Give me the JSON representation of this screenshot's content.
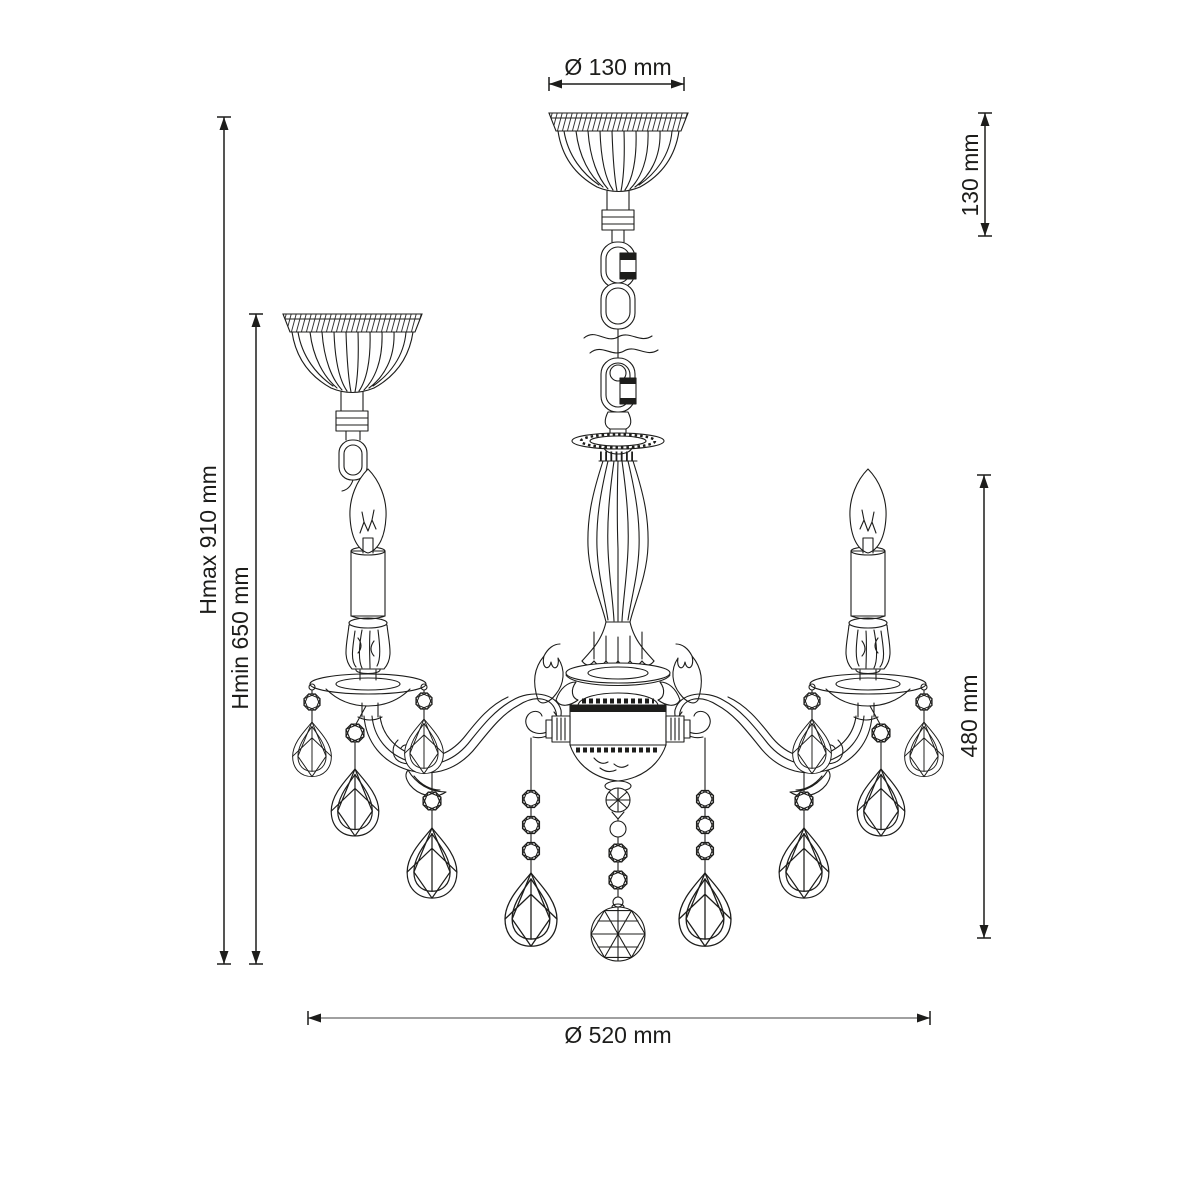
{
  "drawing": {
    "subject": "chandelier-technical-line-drawing",
    "background_color": "#ffffff",
    "line_color": "#1d1d1b",
    "dimension_line_color": "#1d1d1b",
    "bottom_dimension_line_color": "#808080"
  },
  "dimensions": {
    "canopy_diameter": "Ø 130 mm",
    "canopy_height": "130 mm",
    "max_height": "Hmax 910 mm",
    "min_height": "Hmin 650 mm",
    "fixture_height": "480 mm",
    "fixture_diameter": "Ø 520 mm"
  }
}
